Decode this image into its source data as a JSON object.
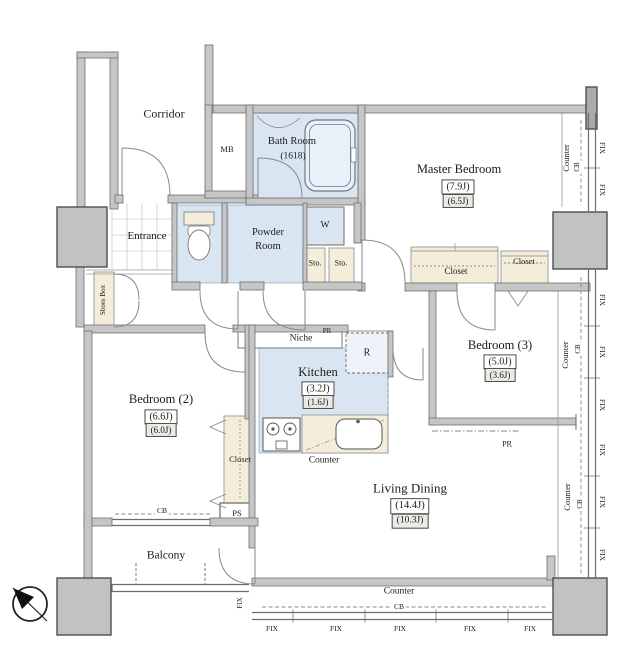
{
  "palette": {
    "room_blue": "#d9e6f2",
    "tub_blue": "#e8f0f8",
    "cabinet_beige": "#f4edda",
    "wall_gray": "#c6c6c6",
    "column_gray": "#c2c2c2",
    "line_gray": "#6e6e6e",
    "text_color": "#1b1b1b"
  },
  "plan": {
    "corridor": "Corridor",
    "mb": "MB",
    "bath": {
      "name": "Bath Room",
      "size": "(1618)"
    },
    "entrance": "Entrance",
    "powder": {
      "line1": "Powder",
      "line2": "Room"
    },
    "w": "W",
    "sto": "Sto.",
    "shoes_box": "Shoes Box",
    "master": {
      "name": "Master Bedroom",
      "area": "(7.9J)",
      "area_net": "(6.5J)"
    },
    "bedroom2": {
      "name": "Bedroom (2)",
      "area": "(6.6J)",
      "area_net": "(6.0J)"
    },
    "bedroom3": {
      "name": "Bedroom (3)",
      "area": "(5.0J)",
      "area_net": "(3.6J)"
    },
    "kitchen": {
      "name": "Kitchen",
      "area": "(3.2J)",
      "area_net": "(1.6J)"
    },
    "living": {
      "name": "Living Dining",
      "area": "(14.4J)",
      "area_net": "(10.3J)"
    },
    "balcony": "Balcony",
    "closet": "Closet",
    "niche": "Niche",
    "pr": "PR",
    "r": "R",
    "counter": "Counter",
    "cb": "CB",
    "ps": "PS",
    "fix": "FIX"
  }
}
